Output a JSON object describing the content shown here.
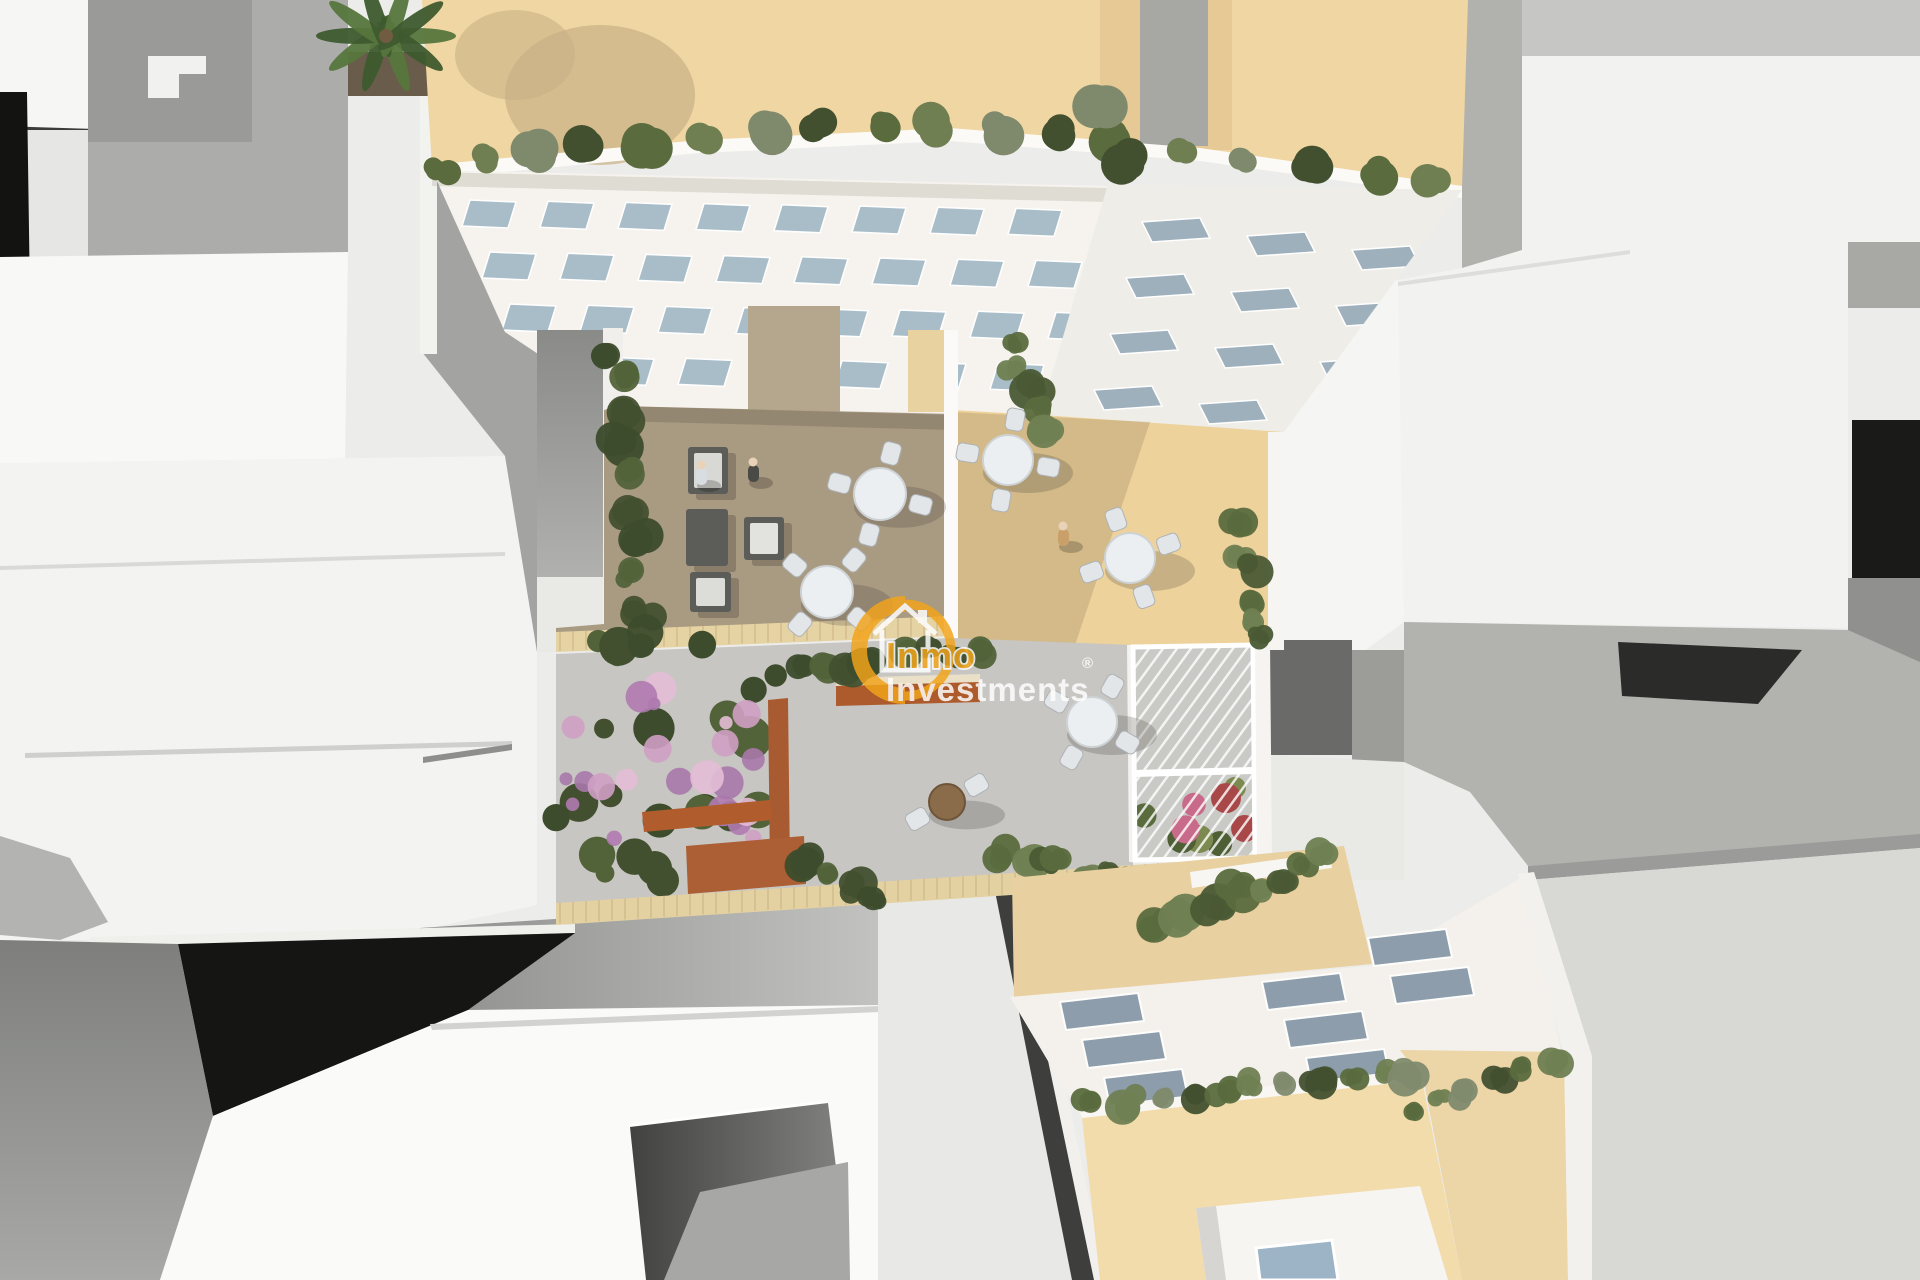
{
  "meta": {
    "kind": "3d-architectural-render",
    "description": "Aerial top-down 3D render of a residential apartment development: white surrounding rooftops, central building with beige roof terrace and window facade, landscaped courtyard with wooden decks, round tables, lounge cubes, flower garden, pergola, and lower building with skylights",
    "canvas_width": 1920,
    "canvas_height": 1280
  },
  "watermark": {
    "line1": "Inmo",
    "line2": "Investments",
    "registered": "®",
    "icon": "house-in-ring-icon",
    "orange": "#F2A41B",
    "text_white": "#FFFFFF"
  },
  "palette": {
    "background": "#ECECEA",
    "white_roof": "#F4F4F2",
    "gray_wall": "#A8A9A6",
    "dark_shadow": "#161616",
    "beige_roof": "#F0D6A2",
    "terrace_beige": "#EED29C",
    "deck_taupe": "#A99A82",
    "patio_concrete": "#C7C6C2",
    "tile_sand": "#E6D3A4",
    "terracotta": "#AD5A2C",
    "foliage_dark": "#42502F",
    "foliage_mid": "#5A6B3E",
    "foliage_light": "#6F7F52",
    "window_glass": "#A9BDC9",
    "skylight": "#8D9DAB",
    "furniture_white": "#ECEFF1",
    "furniture_dark": "#5C5D59",
    "flower_purple": "#A878AB",
    "flower_pink": "#CF9FC4"
  },
  "scene": {
    "south_windows": {
      "rows": 4,
      "cols": 8,
      "x0": 462,
      "y0": 200,
      "dx": 78,
      "dy": 52,
      "row_shift": 20,
      "w": 46,
      "h": 26,
      "skew": 8
    },
    "east_windows": {
      "rows": 4,
      "cols": 3,
      "x0": 1152,
      "y0": 222,
      "dx": 105,
      "dy": 56,
      "row_shift": -16,
      "w": 58,
      "h": 20,
      "skew": -10,
      "col_drop": 14
    },
    "skylights": [
      [
        1060,
        1002
      ],
      [
        1082,
        1040
      ],
      [
        1104,
        1078
      ],
      [
        1262,
        982
      ],
      [
        1284,
        1020
      ],
      [
        1306,
        1058
      ],
      [
        1368,
        938
      ],
      [
        1390,
        976
      ]
    ],
    "tables": [
      {
        "x": 880,
        "y": 494,
        "r": 26,
        "chairs": 4,
        "rot": 15,
        "type": "white"
      },
      {
        "x": 827,
        "y": 592,
        "r": 26,
        "chairs": 4,
        "rot": 40,
        "type": "white"
      },
      {
        "x": 1008,
        "y": 460,
        "r": 25,
        "chairs": 4,
        "rot": 10,
        "type": "white"
      },
      {
        "x": 1130,
        "y": 558,
        "r": 25,
        "chairs": 4,
        "rot": -20,
        "type": "white"
      },
      {
        "x": 1092,
        "y": 722,
        "r": 25,
        "chairs": 4,
        "rot": 30,
        "type": "white"
      },
      {
        "x": 947,
        "y": 802,
        "r": 18,
        "chairs": 2,
        "rot": -30,
        "type": "wood"
      }
    ],
    "people": [
      {
        "x": 701,
        "y": 472,
        "shirt": "#d8dde2"
      },
      {
        "x": 753,
        "y": 469,
        "shirt": "#4a4a46"
      },
      {
        "x": 1063,
        "y": 533,
        "shirt": "#c9a06a"
      }
    ],
    "rim_bushes": [
      [
        440,
        168
      ],
      [
        488,
        160
      ],
      [
        536,
        154
      ],
      [
        590,
        148
      ],
      [
        648,
        143
      ],
      [
        706,
        138
      ],
      [
        764,
        133
      ],
      [
        822,
        128
      ],
      [
        880,
        126
      ],
      [
        938,
        126
      ],
      [
        1000,
        130
      ],
      [
        1058,
        134
      ],
      [
        1118,
        140
      ],
      [
        1180,
        148
      ],
      [
        1245,
        157
      ],
      [
        1310,
        166
      ],
      [
        1372,
        174
      ],
      [
        1432,
        182
      ],
      [
        1102,
        105
      ],
      [
        1128,
        160
      ]
    ],
    "bush_rows": [
      {
        "x0": 614,
        "y0": 348,
        "x1": 642,
        "y1": 640,
        "n": 10,
        "r": 17,
        "pal": "dark"
      },
      {
        "x0": 1012,
        "y0": 340,
        "x1": 1042,
        "y1": 426,
        "n": 5,
        "r": 15,
        "pal": "mid"
      },
      {
        "x0": 1240,
        "y0": 528,
        "x1": 1262,
        "y1": 644,
        "n": 6,
        "r": 15,
        "pal": "mid"
      },
      {
        "x0": 800,
        "y0": 668,
        "x1": 972,
        "y1": 652,
        "n": 8,
        "r": 15,
        "pal": "dark"
      },
      {
        "x0": 1002,
        "y0": 858,
        "x1": 1126,
        "y1": 880,
        "n": 7,
        "r": 16,
        "pal": "mid"
      },
      {
        "x0": 1162,
        "y0": 916,
        "x1": 1326,
        "y1": 862,
        "n": 8,
        "r": 17,
        "pal": "mid"
      },
      {
        "x0": 1092,
        "y0": 1102,
        "x1": 1416,
        "y1": 1072,
        "n": 11,
        "r": 15,
        "pal": "mix"
      },
      {
        "x0": 1408,
        "y0": 1110,
        "x1": 1552,
        "y1": 1062,
        "n": 6,
        "r": 14,
        "pal": "mix"
      },
      {
        "x0": 806,
        "y0": 856,
        "x1": 876,
        "y1": 900,
        "n": 4,
        "r": 15,
        "pal": "dark"
      }
    ],
    "garden": {
      "x": 556,
      "y": 636,
      "w": 232,
      "h": 248,
      "n_green": 24,
      "n_flower": 22
    },
    "pergola": {
      "x": 1133,
      "y": 645,
      "w": 122,
      "h": 215,
      "flowers": 9
    }
  }
}
